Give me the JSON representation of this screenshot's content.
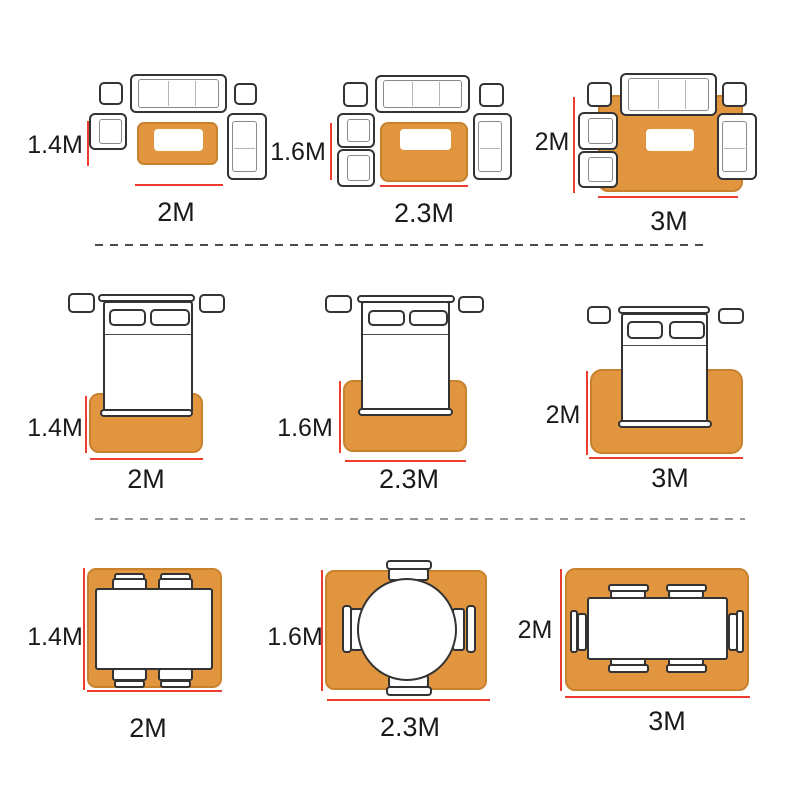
{
  "colors": {
    "rug": "#E2953F",
    "rug_border": "#C8822E",
    "outline": "#333333",
    "inner_line": "#8a8a8a",
    "red": "#ED3B30",
    "divider_top": "#4a4a4a",
    "divider_bottom": "#979797",
    "text": "#1a1a1a",
    "furniture_fill": "#ffffff"
  },
  "rows": [
    {
      "room": "living-room",
      "scenes": [
        {
          "rug_height_label": "1.4M",
          "rug_width_label": "2M"
        },
        {
          "rug_height_label": "1.6M",
          "rug_width_label": "2.3M"
        },
        {
          "rug_height_label": "2M",
          "rug_width_label": "3M"
        }
      ]
    },
    {
      "room": "bedroom",
      "scenes": [
        {
          "rug_height_label": "1.4M",
          "rug_width_label": "2M"
        },
        {
          "rug_height_label": "1.6M",
          "rug_width_label": "2.3M"
        },
        {
          "rug_height_label": "2M",
          "rug_width_label": "3M"
        }
      ]
    },
    {
      "room": "dining-room",
      "scenes": [
        {
          "rug_height_label": "1.4M",
          "rug_width_label": "2M"
        },
        {
          "rug_height_label": "1.6M",
          "rug_width_label": "2.3M"
        },
        {
          "rug_height_label": "2M",
          "rug_width_label": "3M"
        }
      ]
    }
  ]
}
